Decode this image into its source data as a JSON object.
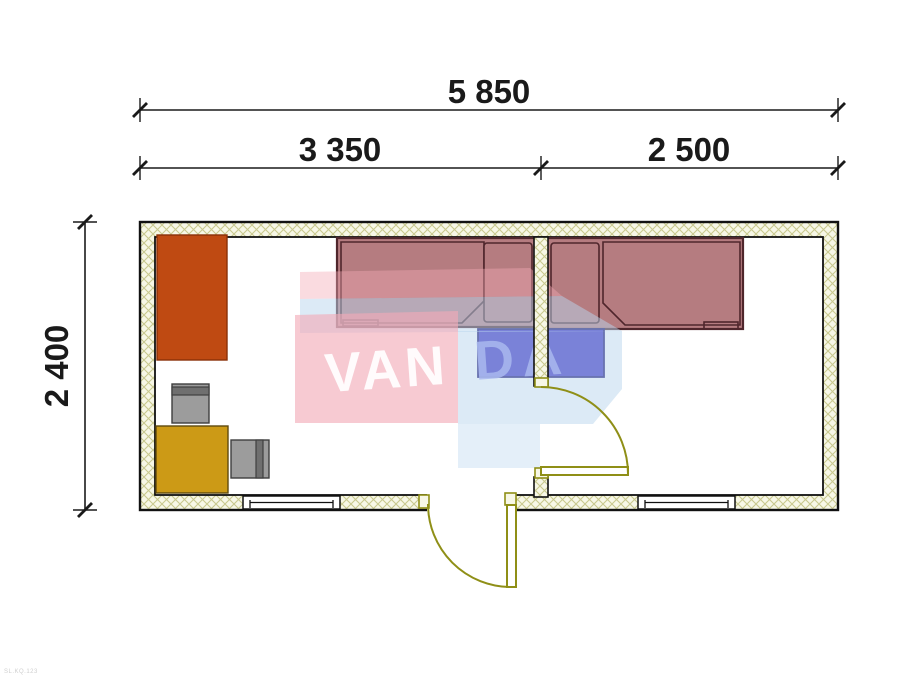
{
  "page": {
    "width": 924,
    "height": 700,
    "background": "#ffffff",
    "type": "floor-plan-drawing"
  },
  "dimensions": {
    "total_width": "5 850",
    "left_room_width": "3 350",
    "right_room_width": "2 500",
    "depth": "2 400"
  },
  "watermark": {
    "text_left": "VAN",
    "text_right": "DA"
  },
  "corner_microtext": "SL.KQ.123",
  "rooms": [
    {
      "name": "left-room",
      "width_label": "3 350",
      "contents": [
        "wardrobe",
        "chair",
        "cabinet",
        "chair",
        "single-bed",
        "nightstand",
        "window",
        "exterior-door"
      ]
    },
    {
      "name": "right-room",
      "width_label": "2 500",
      "contents": [
        "single-bed",
        "nightstand",
        "window",
        "interior-door"
      ]
    }
  ],
  "colors": {
    "dim_color": "#1a1a1a",
    "wall_border": "#111111",
    "wall_fill": "#f7f7e6",
    "wall_hatch_line": "#c9c98f",
    "door_olive": "#8f8f17",
    "bed_fill": "#b57c80",
    "bed_border": "#4f262c",
    "nightstand_blue": "#3a2ec2",
    "nightstand_border": "#191070",
    "wardrobe_orange": "#bf4a12",
    "wardrobe_border": "#8a3008",
    "cabinet_yellow": "#cc9a16",
    "cabinet_border": "#5f4a0e",
    "chair_gray": "#9c9c9c",
    "chair_dark": "#6f6f6f",
    "chair_border": "#3f3f3f",
    "watermark_pink": "#f2a9b6",
    "watermark_blue": "#b9d6ee",
    "watermark_text_light": "#ffffff",
    "watermark_text_blue": "#a9b9ee",
    "microtext_gray": "#cfcfcf"
  }
}
